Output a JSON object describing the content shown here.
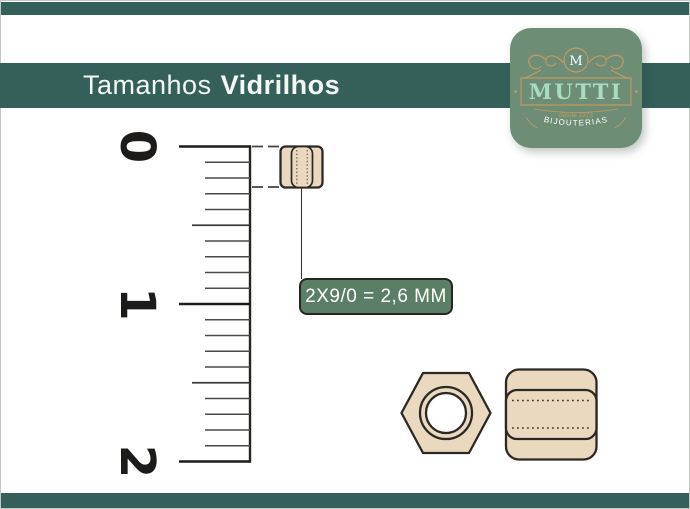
{
  "header": {
    "title_light": "Tamanhos",
    "title_bold": "Vidrilhos"
  },
  "logo": {
    "monogram": "M",
    "brand": "MUTTI",
    "tagline": "desde 1973",
    "subtitle": "BIJOUTERIAS"
  },
  "ruler": {
    "labels": [
      "0",
      "1",
      "2"
    ],
    "minor_divisions_per_unit": 10
  },
  "size_label": {
    "text": "2X9/0 = 2,6 MM"
  },
  "colors": {
    "page_bg": "#ffffff",
    "bar_green": "#35605a",
    "badge_green": "#6d8e75",
    "label_green": "#5a7f66",
    "bead_fill": "#ead8bf",
    "gold": "#c29a62",
    "mint": "#a9dcc1",
    "tick_gray": "#4a4a4a"
  }
}
